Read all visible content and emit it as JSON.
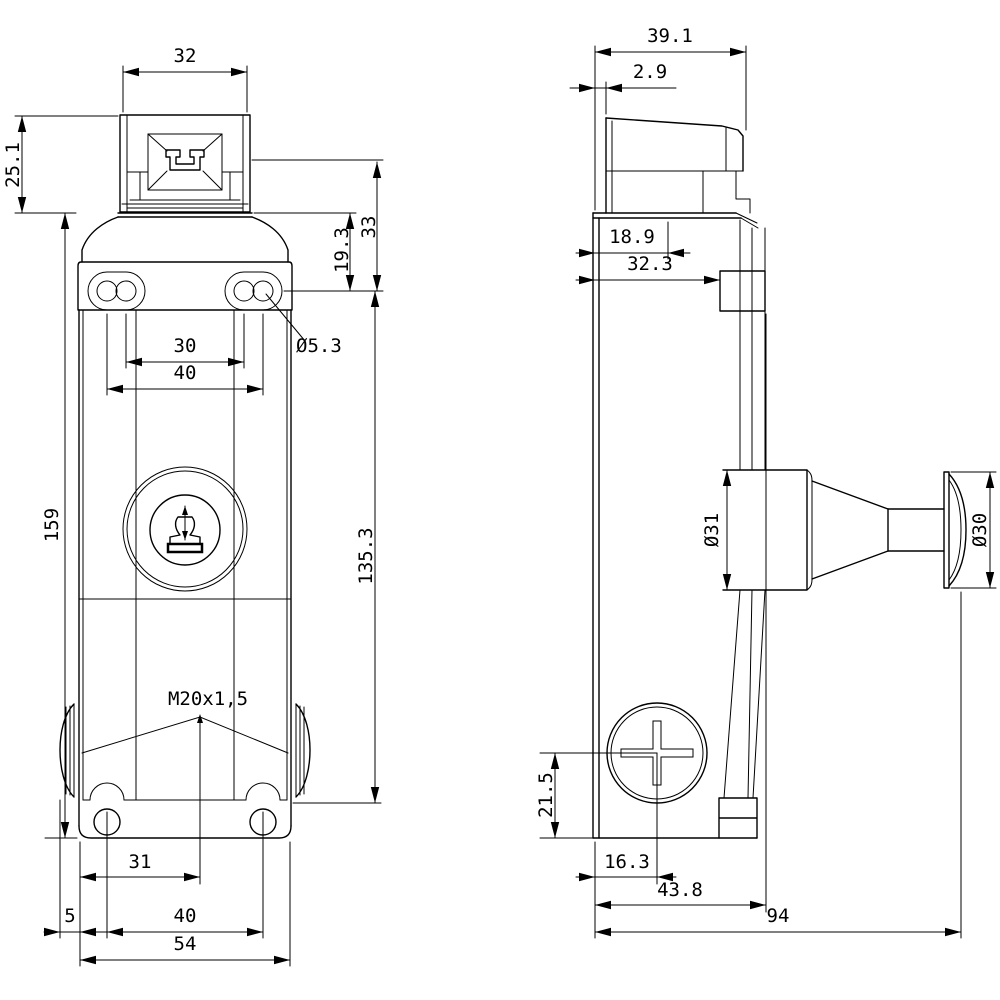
{
  "drawing": {
    "type": "technical dimension drawing, 2 orthographic views of a position switch with plunger actuator",
    "background_color": "#ffffff",
    "line_color": "#000000",
    "front_view": {
      "head_width": "32",
      "head_height": "25.1",
      "body_height": "159",
      "head_axis_to_slot_centers": "33",
      "body_top_to_slot_centers": "19.3",
      "slot_inner_center_spacing": "30",
      "slot_outer_center_spacing": "40",
      "slot_hole_diameter": "Ø5.3",
      "slot_centers_to_base": "135.3",
      "cable_entry_thread": "M20x1,5",
      "base_edge_to_entry_axis": "31",
      "gland_protrusion": "5",
      "base_hole_spacing": "40",
      "base_width": "54"
    },
    "side_view": {
      "head_depth": "39.1",
      "head_front_face_offset": "2.9",
      "wall_to_head_axis": "18.9",
      "wall_to_clamp_face": "32.3",
      "plunger_diameter": "Ø31",
      "plunger_cap_diameter": "Ø30",
      "base_to_screw_axis": "21.5",
      "wall_to_screw_axis": "16.3",
      "wall_to_body_front": "43.8",
      "overall_depth": "94"
    }
  }
}
